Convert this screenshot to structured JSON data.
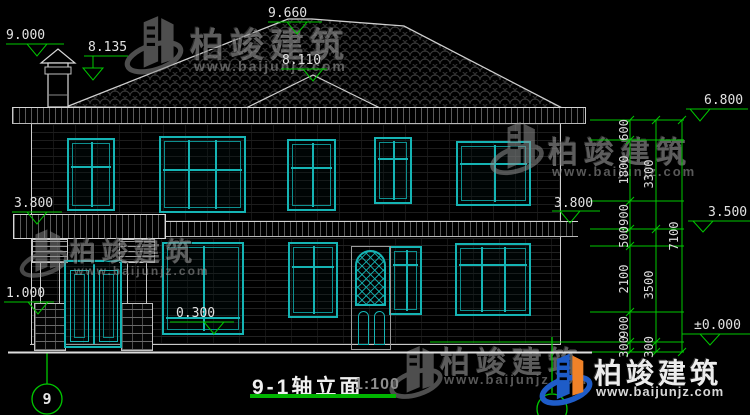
{
  "drawing": {
    "title": "9-1轴立面",
    "scale": "1:100",
    "axis_bubble_left": "9",
    "elevation_marks": {
      "chimney_top": "9.000",
      "roof_slope": "8.135",
      "ridge": "9.660",
      "front_hip": "8.110",
      "eave_right": "6.800",
      "canopy_left": "3.800",
      "canopy_right": "3.800",
      "second_floor": "3.500",
      "pedestal_top": "1.000",
      "indoor_floor": "0.300",
      "ground_zero": "±0.000"
    },
    "dimensions": {
      "segments": [
        "600",
        "1800",
        "900",
        "500",
        "2100",
        "900",
        "300"
      ],
      "subtotals": [
        "3300",
        "3500",
        "300"
      ],
      "total": "7100"
    }
  },
  "watermark": {
    "brand": "柏竣建筑",
    "website": "www.baijunjz.com"
  },
  "colors": {
    "background": "#000000",
    "line_white": "#d8d8d8",
    "window_cyan": "#15b4b4",
    "annotation_green": "#00c800",
    "logo_blue": "#1e5cc8",
    "logo_orange": "#f08228"
  }
}
